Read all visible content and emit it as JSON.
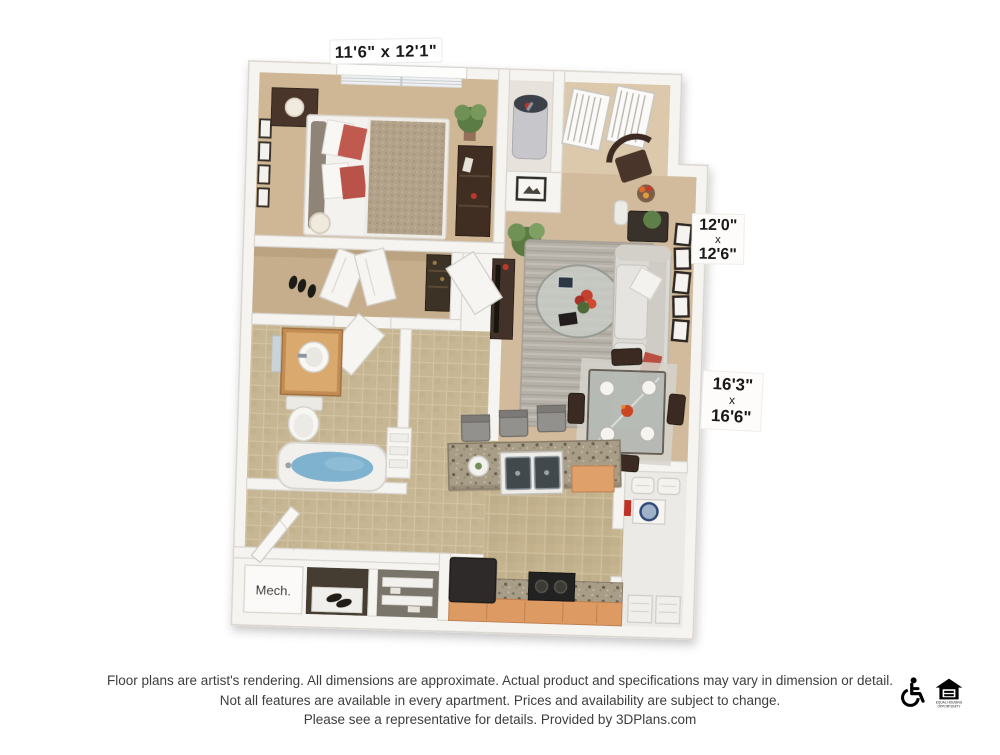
{
  "floor_plan": {
    "dimension_labels": {
      "bedroom": "11'6\" x 12'1\"",
      "living": [
        "12'0\"",
        "x",
        "12'6\""
      ],
      "great_room": [
        "16'3\"",
        "x",
        "16'6\""
      ]
    },
    "room_labels": {
      "mech": "Mech."
    },
    "colors": {
      "wall": "#f6f4f1",
      "carpet": "#d0b999",
      "tile": "#c2b18c",
      "accent_pillow_red": "#bf5348",
      "bath_water_blue": "#7fb2ce",
      "cabinet_wood": "#dd9a64"
    }
  },
  "disclaimer": {
    "line1": "Floor plans are artist's rendering. All dimensions are approximate. Actual product and specifications may vary in dimension or detail.",
    "line2": "Not all features are available in every apartment. Prices and availability are subject to change.",
    "line3": "Please see a representative for details. Provided by 3DPlans.com"
  },
  "footer_icons": {
    "accessibility": "wheelchair-accessible-icon",
    "equal_housing": "equal-housing-opportunity-icon",
    "equal_housing_caption_1": "EQUAL HOUSING",
    "equal_housing_caption_2": "OPPORTUNITY"
  }
}
